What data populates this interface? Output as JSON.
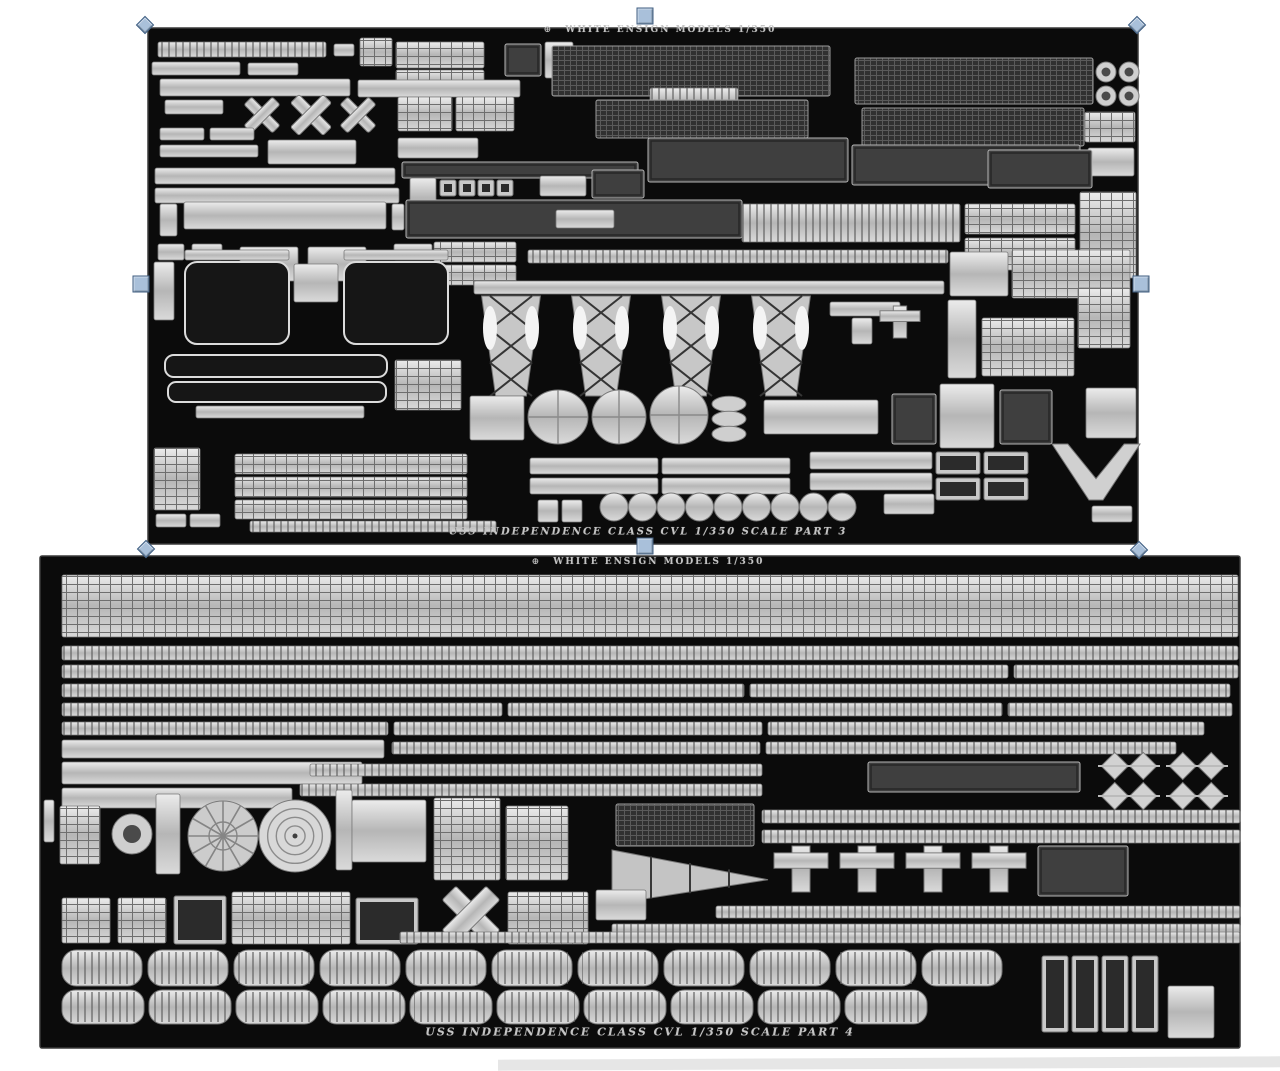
{
  "app": {
    "canvas_background": "#ffffff",
    "partial_sheet_edge_color": "#cdcdcd"
  },
  "palette": {
    "sheet_background": "#0b0b0b",
    "sheet_edge": "#3a3a3a",
    "metal_light": "#ececec",
    "metal_mid": "#b8b8b8",
    "metal_dark": "#8f8f8f",
    "etch_dark": "#3f3f3f",
    "label_color": "#c4c4c4"
  },
  "sheets": [
    {
      "id": "part-3",
      "x": 148,
      "y": 28,
      "w": 990,
      "h": 516,
      "selected": true,
      "logo_glyph": "⊕",
      "label_top": {
        "text": "WHITE ENSIGN MODELS    1/350",
        "cx": 660,
        "cy": 30,
        "size": 9
      },
      "label_bottom": {
        "text": "USS INDEPENDENCE CLASS CVL   1/350 SCALE    PART 3",
        "cx": 648,
        "cy": 532,
        "size": 10
      }
    },
    {
      "id": "part-4",
      "x": 40,
      "y": 556,
      "w": 1200,
      "h": 492,
      "selected": false,
      "logo_glyph": "⊕",
      "label_top": {
        "text": "WHITE ENSIGN MODELS    1/350",
        "cx": 648,
        "cy": 562,
        "size": 9
      },
      "label_bottom": {
        "text": "USS INDEPENDENCE CLASS CVL   1/350 SCALE    PART 4",
        "cx": 640,
        "cy": 1032,
        "size": 11
      }
    }
  ],
  "selection": {
    "target_sheet": "part-3",
    "fill": "#a9c0da",
    "border": "#3f5e82",
    "handles": [
      {
        "name": "top-left",
        "shape": "diamond",
        "x": 145,
        "y": 25
      },
      {
        "name": "top-center",
        "shape": "square",
        "x": 645,
        "y": 16
      },
      {
        "name": "top-right",
        "shape": "diamond",
        "x": 1137,
        "y": 25
      },
      {
        "name": "middle-left",
        "shape": "square",
        "x": 141,
        "y": 284
      },
      {
        "name": "middle-right",
        "shape": "square",
        "x": 1141,
        "y": 284
      },
      {
        "name": "bottom-left",
        "shape": "diamond",
        "x": 146,
        "y": 549
      },
      {
        "name": "bottom-center",
        "shape": "square",
        "x": 645,
        "y": 546
      },
      {
        "name": "bottom-right",
        "shape": "diamond",
        "x": 1139,
        "y": 550
      }
    ]
  },
  "fret_parts": {
    "part-3": [
      [
        "r",
        158,
        42,
        168,
        15
      ],
      [
        "s",
        334,
        44,
        20,
        12
      ],
      [
        "g",
        360,
        38,
        32,
        28
      ],
      [
        "g",
        396,
        42,
        88,
        26
      ],
      [
        "g",
        396,
        70,
        88,
        22
      ],
      [
        "d",
        505,
        44,
        36,
        32
      ],
      [
        "s",
        545,
        42,
        28,
        36
      ],
      [
        "s",
        152,
        62,
        88,
        13
      ],
      [
        "s",
        248,
        63,
        50,
        12
      ],
      [
        "s",
        160,
        79,
        190,
        17
      ],
      [
        "s",
        358,
        80,
        162,
        17
      ],
      [
        "m",
        552,
        46,
        278,
        50
      ],
      [
        "r",
        650,
        88,
        88,
        26
      ],
      [
        "m",
        596,
        100,
        212,
        38
      ],
      [
        "m",
        855,
        58,
        238,
        46
      ],
      [
        "m",
        862,
        108,
        222,
        38
      ],
      [
        "c",
        1096,
        62,
        20,
        20
      ],
      [
        "c",
        1119,
        62,
        20,
        20
      ],
      [
        "c",
        1096,
        86,
        20,
        20
      ],
      [
        "c",
        1119,
        86,
        20,
        20
      ],
      [
        "g",
        1085,
        112,
        50,
        30
      ],
      [
        "s",
        1088,
        148,
        46,
        28
      ],
      [
        "s",
        165,
        100,
        58,
        14
      ],
      [
        "x",
        242,
        98,
        40,
        34
      ],
      [
        "x",
        288,
        96,
        46,
        38
      ],
      [
        "x",
        338,
        98,
        40,
        34
      ],
      [
        "g",
        398,
        97,
        54,
        34
      ],
      [
        "g",
        456,
        97,
        58,
        34
      ],
      [
        "s",
        160,
        128,
        44,
        12
      ],
      [
        "s",
        210,
        128,
        44,
        12
      ],
      [
        "s",
        160,
        145,
        98,
        12
      ],
      [
        "s",
        268,
        140,
        88,
        24
      ],
      [
        "s",
        398,
        138,
        80,
        20
      ],
      [
        "d",
        402,
        162,
        236,
        16
      ],
      [
        "d",
        648,
        138,
        200,
        44
      ],
      [
        "d",
        852,
        145,
        228,
        40
      ],
      [
        "d",
        988,
        150,
        104,
        38
      ],
      [
        "s",
        155,
        168,
        240,
        16
      ],
      [
        "s",
        155,
        188,
        244,
        15
      ],
      [
        "s",
        410,
        178,
        26,
        40
      ],
      [
        "b",
        440,
        180,
        16,
        16
      ],
      [
        "b",
        459,
        180,
        16,
        16
      ],
      [
        "b",
        478,
        180,
        16,
        16
      ],
      [
        "b",
        497,
        180,
        16,
        16
      ],
      [
        "s",
        540,
        176,
        46,
        20
      ],
      [
        "d",
        592,
        170,
        52,
        28
      ],
      [
        "g",
        1080,
        192,
        56,
        86
      ],
      [
        "s",
        160,
        204,
        17,
        32
      ],
      [
        "s",
        184,
        202,
        202,
        27
      ],
      [
        "s",
        392,
        204,
        12,
        26
      ],
      [
        "d",
        406,
        200,
        336,
        38
      ],
      [
        "s",
        556,
        210,
        58,
        18
      ],
      [
        "r",
        742,
        204,
        218,
        38
      ],
      [
        "g",
        965,
        204,
        110,
        30
      ],
      [
        "g",
        965,
        238,
        110,
        32
      ],
      [
        "s",
        158,
        244,
        26,
        16
      ],
      [
        "s",
        192,
        244,
        30,
        16
      ],
      [
        "s",
        240,
        247,
        58,
        34
      ],
      [
        "s",
        308,
        247,
        58,
        34
      ],
      [
        "s",
        394,
        244,
        38,
        16
      ],
      [
        "g",
        434,
        242,
        82,
        20
      ],
      [
        "g",
        434,
        265,
        82,
        20
      ],
      [
        "r",
        528,
        250,
        420,
        13
      ],
      [
        "s",
        154,
        262,
        20,
        58
      ],
      [
        "s",
        185,
        250,
        104,
        10
      ],
      [
        "s",
        344,
        250,
        104,
        10
      ],
      [
        "o",
        185,
        262,
        104,
        82
      ],
      [
        "o",
        344,
        262,
        104,
        82
      ],
      [
        "s",
        294,
        264,
        44,
        38
      ],
      [
        "s",
        474,
        281,
        470,
        13
      ],
      [
        "s",
        950,
        252,
        58,
        44
      ],
      [
        "g",
        1012,
        250,
        118,
        48
      ],
      [
        "l",
        476,
        296,
        70,
        100
      ],
      [
        "l",
        566,
        296,
        70,
        100
      ],
      [
        "l",
        656,
        296,
        70,
        100
      ],
      [
        "l",
        746,
        296,
        70,
        100
      ],
      [
        "s",
        830,
        302,
        70,
        14
      ],
      [
        "s",
        852,
        318,
        20,
        26
      ],
      [
        "+",
        880,
        306,
        40,
        32
      ],
      [
        "s",
        948,
        300,
        28,
        78
      ],
      [
        "g",
        982,
        318,
        92,
        58
      ],
      [
        "g",
        1078,
        288,
        52,
        60
      ],
      [
        "s",
        470,
        396,
        54,
        44
      ],
      [
        "e",
        528,
        390,
        60,
        54
      ],
      [
        "e",
        592,
        390,
        54,
        54
      ],
      [
        "e",
        650,
        386,
        58,
        58
      ],
      [
        "st",
        712,
        394,
        34,
        50
      ],
      [
        "s",
        764,
        400,
        114,
        34
      ],
      [
        "d",
        892,
        394,
        44,
        50
      ],
      [
        "s",
        940,
        384,
        54,
        64
      ],
      [
        "d",
        1000,
        390,
        52,
        54
      ],
      [
        "s",
        1086,
        388,
        50,
        50
      ],
      [
        "o",
        165,
        355,
        222,
        22
      ],
      [
        "o",
        168,
        382,
        218,
        20
      ],
      [
        "s",
        196,
        406,
        168,
        12
      ],
      [
        "g",
        395,
        360,
        66,
        50
      ],
      [
        "g",
        154,
        448,
        46,
        62
      ],
      [
        "s",
        156,
        514,
        30,
        13
      ],
      [
        "s",
        190,
        514,
        30,
        13
      ],
      [
        "g",
        235,
        454,
        232,
        20
      ],
      [
        "g",
        235,
        477,
        232,
        20
      ],
      [
        "g",
        235,
        500,
        232,
        19
      ],
      [
        "r",
        250,
        521,
        246,
        11
      ],
      [
        "s",
        530,
        458,
        128,
        16
      ],
      [
        "s",
        662,
        458,
        128,
        16
      ],
      [
        "s",
        530,
        478,
        128,
        16
      ],
      [
        "s",
        662,
        478,
        128,
        16
      ],
      [
        "s",
        538,
        500,
        20,
        22
      ],
      [
        "s",
        562,
        500,
        20,
        22
      ],
      [
        "ch",
        600,
        492,
        260,
        30
      ],
      [
        "s",
        810,
        452,
        122,
        17
      ],
      [
        "s",
        810,
        473,
        122,
        17
      ],
      [
        "b",
        936,
        452,
        44,
        22
      ],
      [
        "b",
        984,
        452,
        44,
        22
      ],
      [
        "b",
        936,
        478,
        44,
        22
      ],
      [
        "b",
        984,
        478,
        44,
        22
      ],
      [
        "s",
        884,
        494,
        50,
        20
      ],
      [
        "w",
        1052,
        444,
        88,
        56
      ],
      [
        "s",
        1092,
        506,
        40,
        16
      ]
    ],
    "part-4": [
      [
        "g",
        62,
        575,
        1176,
        62
      ],
      [
        "r",
        62,
        646,
        1176,
        14
      ],
      [
        "r",
        62,
        665,
        946,
        13
      ],
      [
        "r",
        1014,
        665,
        224,
        13
      ],
      [
        "r",
        62,
        684,
        682,
        13
      ],
      [
        "r",
        750,
        684,
        480,
        13
      ],
      [
        "r",
        62,
        703,
        440,
        13
      ],
      [
        "r",
        508,
        703,
        494,
        13
      ],
      [
        "r",
        1008,
        703,
        224,
        13
      ],
      [
        "r",
        62,
        722,
        326,
        13
      ],
      [
        "r",
        394,
        722,
        368,
        13
      ],
      [
        "r",
        768,
        722,
        436,
        13
      ],
      [
        "s",
        62,
        740,
        322,
        18
      ],
      [
        "r",
        392,
        742,
        368,
        12
      ],
      [
        "r",
        766,
        742,
        410,
        12
      ],
      [
        "s",
        62,
        762,
        300,
        22
      ],
      [
        "r",
        310,
        764,
        452,
        12
      ],
      [
        "d",
        868,
        762,
        212,
        30
      ],
      [
        "dm",
        1098,
        754,
        62,
        24
      ],
      [
        "dm",
        1166,
        754,
        62,
        24
      ],
      [
        "dm",
        1098,
        784,
        62,
        24
      ],
      [
        "dm",
        1166,
        784,
        62,
        24
      ],
      [
        "s",
        62,
        788,
        230,
        20
      ],
      [
        "r",
        300,
        784,
        462,
        12
      ],
      [
        "s",
        44,
        800,
        10,
        42
      ],
      [
        "g",
        60,
        806,
        40,
        58
      ],
      [
        "c",
        112,
        814,
        40,
        40
      ],
      [
        "s",
        156,
        794,
        24,
        80
      ],
      [
        "f",
        188,
        800,
        70,
        72
      ],
      [
        "C",
        258,
        800,
        74,
        72
      ],
      [
        "s",
        336,
        790,
        16,
        80
      ],
      [
        "s",
        352,
        800,
        74,
        62
      ],
      [
        "g",
        434,
        798,
        66,
        82
      ],
      [
        "g",
        506,
        806,
        62,
        74
      ],
      [
        "m",
        616,
        804,
        138,
        42
      ],
      [
        "r",
        762,
        810,
        478,
        13
      ],
      [
        "r",
        762,
        830,
        478,
        13
      ],
      [
        "t",
        612,
        850,
        156,
        54
      ],
      [
        "+",
        774,
        846,
        54,
        46
      ],
      [
        "+",
        840,
        846,
        54,
        46
      ],
      [
        "+",
        906,
        846,
        54,
        46
      ],
      [
        "+",
        972,
        846,
        54,
        46
      ],
      [
        "d",
        1038,
        846,
        90,
        50
      ],
      [
        "r",
        716,
        906,
        524,
        12
      ],
      [
        "r",
        612,
        924,
        628,
        12
      ],
      [
        "g",
        62,
        898,
        48,
        45
      ],
      [
        "g",
        118,
        898,
        48,
        45
      ],
      [
        "b",
        174,
        896,
        52,
        48
      ],
      [
        "g",
        232,
        892,
        118,
        52
      ],
      [
        "b",
        356,
        898,
        62,
        46
      ],
      [
        "x",
        440,
        884,
        62,
        62
      ],
      [
        "g",
        508,
        892,
        80,
        52
      ],
      [
        "s",
        596,
        890,
        50,
        30
      ],
      [
        "r",
        400,
        932,
        840,
        11
      ],
      [
        "v",
        62,
        950,
        80,
        36
      ],
      [
        "v",
        148,
        950,
        80,
        36
      ],
      [
        "v",
        234,
        950,
        80,
        36
      ],
      [
        "v",
        320,
        950,
        80,
        36
      ],
      [
        "v",
        406,
        950,
        80,
        36
      ],
      [
        "v",
        492,
        950,
        80,
        36
      ],
      [
        "v",
        578,
        950,
        80,
        36
      ],
      [
        "v",
        664,
        950,
        80,
        36
      ],
      [
        "v",
        750,
        950,
        80,
        36
      ],
      [
        "v",
        836,
        950,
        80,
        36
      ],
      [
        "v",
        922,
        950,
        80,
        36
      ],
      [
        "v",
        62,
        990,
        82,
        34
      ],
      [
        "v",
        149,
        990,
        82,
        34
      ],
      [
        "v",
        236,
        990,
        82,
        34
      ],
      [
        "v",
        323,
        990,
        82,
        34
      ],
      [
        "v",
        410,
        990,
        82,
        34
      ],
      [
        "v",
        497,
        990,
        82,
        34
      ],
      [
        "v",
        584,
        990,
        82,
        34
      ],
      [
        "v",
        671,
        990,
        82,
        34
      ],
      [
        "v",
        758,
        990,
        82,
        34
      ],
      [
        "v",
        845,
        990,
        82,
        34
      ],
      [
        "b",
        1042,
        956,
        26,
        76
      ],
      [
        "b",
        1072,
        956,
        26,
        76
      ],
      [
        "b",
        1102,
        956,
        26,
        76
      ],
      [
        "b",
        1132,
        956,
        26,
        76
      ],
      [
        "s",
        1168,
        986,
        46,
        52
      ]
    ]
  }
}
